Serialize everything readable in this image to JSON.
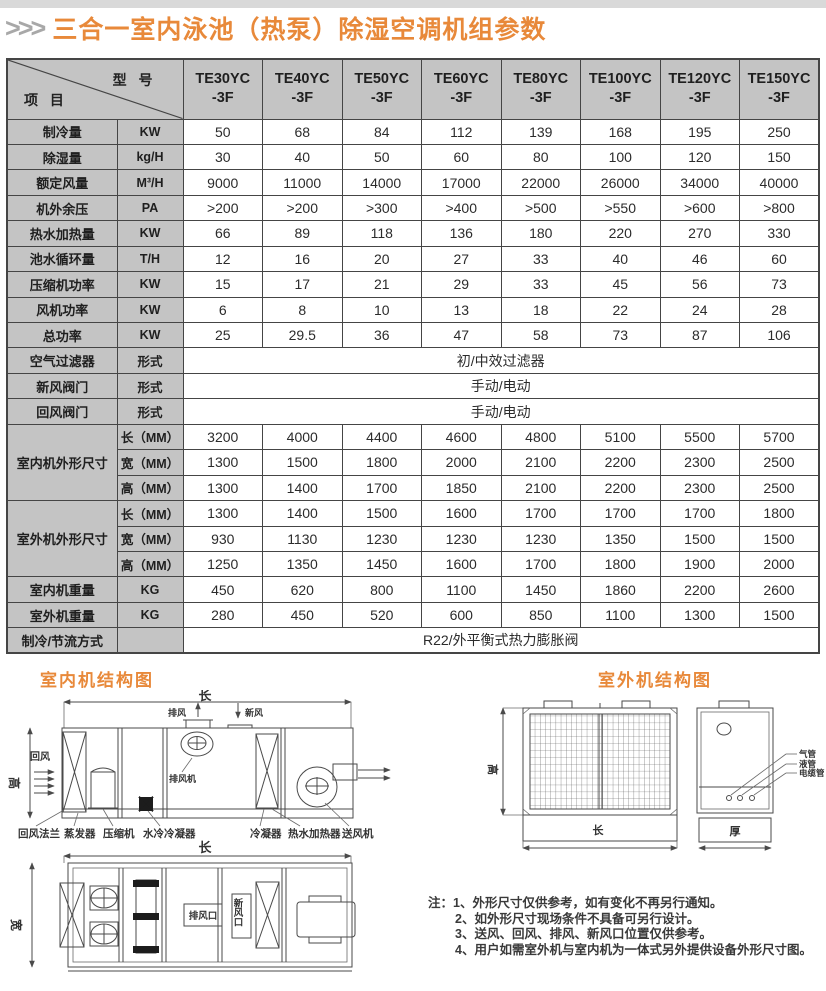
{
  "header": {
    "arrows": ">>>",
    "title": "三合一室内泳池（热泵）除湿空调机组参数"
  },
  "table": {
    "corner_top": "型 号",
    "corner_bottom": "项 目",
    "models": [
      {
        "name": "TE30YC",
        "suffix": "-3F"
      },
      {
        "name": "TE40YC",
        "suffix": "-3F"
      },
      {
        "name": "TE50YC",
        "suffix": "-3F"
      },
      {
        "name": "TE60YC",
        "suffix": "-3F"
      },
      {
        "name": "TE80YC",
        "suffix": "-3F"
      },
      {
        "name": "TE100YC",
        "suffix": "-3F"
      },
      {
        "name": "TE120YC",
        "suffix": "-3F"
      },
      {
        "name": "TE150YC",
        "suffix": "-3F"
      }
    ],
    "rows": [
      {
        "type": "values",
        "label": "制冷量",
        "unit": "KW",
        "values": [
          "50",
          "68",
          "84",
          "112",
          "139",
          "168",
          "195",
          "250"
        ]
      },
      {
        "type": "values",
        "label": "除湿量",
        "unit": "kg/H",
        "values": [
          "30",
          "40",
          "50",
          "60",
          "80",
          "100",
          "120",
          "150"
        ]
      },
      {
        "type": "values",
        "label": "额定风量",
        "unit": "M³/H",
        "values": [
          "9000",
          "11000",
          "14000",
          "17000",
          "22000",
          "26000",
          "34000",
          "40000"
        ]
      },
      {
        "type": "values",
        "label": "机外余压",
        "unit": "PA",
        "values": [
          ">200",
          ">200",
          ">300",
          ">400",
          ">500",
          ">550",
          ">600",
          ">800"
        ]
      },
      {
        "type": "values",
        "label": "热水加热量",
        "unit": "KW",
        "values": [
          "66",
          "89",
          "118",
          "136",
          "180",
          "220",
          "270",
          "330"
        ]
      },
      {
        "type": "values",
        "label": "池水循环量",
        "unit": "T/H",
        "values": [
          "12",
          "16",
          "20",
          "27",
          "33",
          "40",
          "46",
          "60"
        ]
      },
      {
        "type": "values",
        "label": "压缩机功率",
        "unit": "KW",
        "values": [
          "15",
          "17",
          "21",
          "29",
          "33",
          "45",
          "56",
          "73"
        ]
      },
      {
        "type": "values",
        "label": "风机功率",
        "unit": "KW",
        "values": [
          "6",
          "8",
          "10",
          "13",
          "18",
          "22",
          "24",
          "28"
        ]
      },
      {
        "type": "values",
        "label": "总功率",
        "unit": "KW",
        "values": [
          "25",
          "29.5",
          "36",
          "47",
          "58",
          "73",
          "87",
          "106"
        ]
      },
      {
        "type": "span",
        "label": "空气过滤器",
        "unit": "形式",
        "value": "初/中效过滤器"
      },
      {
        "type": "span",
        "label": "新风阀门",
        "unit": "形式",
        "value": "手动/电动"
      },
      {
        "type": "span",
        "label": "回风阀门",
        "unit": "形式",
        "value": "手动/电动"
      },
      {
        "type": "group",
        "label": "室内机外形尺寸",
        "subrows": [
          {
            "unit": "长（MM）",
            "values": [
              "3200",
              "4000",
              "4400",
              "4600",
              "4800",
              "5100",
              "5500",
              "5700"
            ]
          },
          {
            "unit": "宽（MM）",
            "values": [
              "1300",
              "1500",
              "1800",
              "2000",
              "2100",
              "2200",
              "2300",
              "2500"
            ]
          },
          {
            "unit": "高（MM）",
            "values": [
              "1300",
              "1400",
              "1700",
              "1850",
              "2100",
              "2200",
              "2300",
              "2500"
            ]
          }
        ]
      },
      {
        "type": "group",
        "label": "室外机外形尺寸",
        "subrows": [
          {
            "unit": "长（MM）",
            "values": [
              "1300",
              "1400",
              "1500",
              "1600",
              "1700",
              "1700",
              "1700",
              "1800"
            ]
          },
          {
            "unit": "宽（MM）",
            "values": [
              "930",
              "1130",
              "1230",
              "1230",
              "1230",
              "1350",
              "1500",
              "1500"
            ]
          },
          {
            "unit": "高（MM）",
            "values": [
              "1250",
              "1350",
              "1450",
              "1600",
              "1700",
              "1800",
              "1900",
              "2000"
            ]
          }
        ]
      },
      {
        "type": "values",
        "label": "室内机重量",
        "unit": "KG",
        "values": [
          "450",
          "620",
          "800",
          "1100",
          "1450",
          "1860",
          "2200",
          "2600"
        ]
      },
      {
        "type": "values",
        "label": "室外机重量",
        "unit": "KG",
        "values": [
          "280",
          "450",
          "520",
          "600",
          "850",
          "1100",
          "1300",
          "1500"
        ]
      },
      {
        "type": "span",
        "label": "制冷/节流方式",
        "unit": "",
        "value": "R22/外平衡式热力膨胀阀"
      }
    ]
  },
  "diagrams": {
    "indoor": {
      "title": "室内机结构图",
      "dim_length": "长",
      "dim_height": "高",
      "dim_width": "宽",
      "return_air": "回风",
      "exhaust_air": "排风",
      "fresh_air": "新风",
      "exhaust_fan_label": "排风机",
      "exhaust_outlet": "排风口",
      "fresh_outlet": "新风口",
      "labels_bottom": [
        "回风法兰",
        "蒸发器",
        "压缩机",
        "水冷冷凝器",
        "冷凝器",
        "热水加热器",
        "送风机"
      ]
    },
    "outdoor": {
      "title": "室外机结构图",
      "dim_height": "高",
      "dim_length": "长",
      "dim_depth": "厚",
      "pipe_labels": [
        "气管",
        "液管",
        "电缆管"
      ]
    }
  },
  "notes": {
    "prefix": "注：",
    "items": [
      "1、外形尺寸仅供参考，如有变化不再另行通知。",
      "2、如外形尺寸现场条件不具备可另行设计。",
      "3、送风、回风、排风、新风口位置仅供参考。",
      "4、用户如需室外机与室内机为一体式另外提供设备外形尺寸图。"
    ]
  }
}
